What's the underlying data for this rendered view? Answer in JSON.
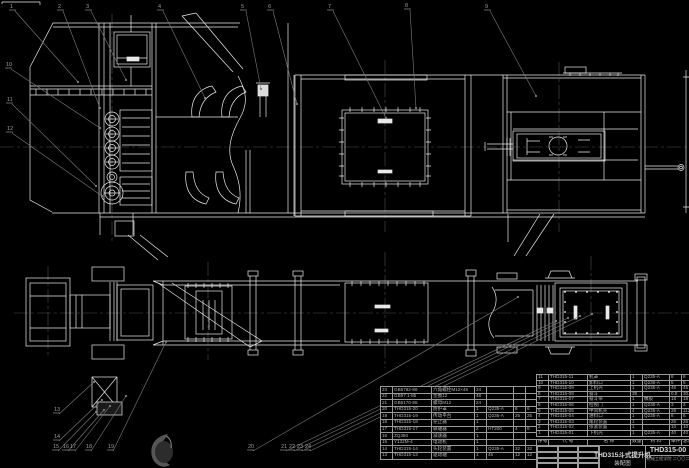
{
  "colors": {
    "background": "#000000",
    "line": "#e9e9e9",
    "leader": "#7d7d7d",
    "balloon_text": "#9c9c9c",
    "centerline": "#4f4f4f",
    "table_line": "#9a9a9a",
    "table_text": "#b5b5b5"
  },
  "title_block": {
    "title_line1": "THD315斗式提升机",
    "title_line2": "装配图",
    "drawing_number": "THD315-00",
    "org_line": "机械工程学院 二〇〇二"
  },
  "bom": {
    "header": [
      "序号",
      "代  号",
      "名  称",
      "数量",
      "材  料",
      "单件",
      "总计",
      "备注"
    ],
    "rows_right": [
      [
        "11",
        "THD315-11",
        "机罩",
        "1",
        "Q235-A",
        "8",
        "8",
        ""
      ],
      [
        "10",
        "THD315-10",
        "卸料口",
        "1",
        "Q235-A",
        "5",
        "5",
        ""
      ],
      [
        "9",
        "THD315-09",
        "上机壳",
        "1",
        "Q235-A",
        "45",
        "45",
        ""
      ],
      [
        "8",
        "THD315-08",
        "畚斗",
        "38",
        "",
        "0.8",
        "30.4",
        "外购"
      ],
      [
        "7",
        "THD315-07",
        "畚斗带",
        "1",
        "橡胶",
        "18",
        "18",
        "外购"
      ],
      [
        "6",
        "THD315-06",
        "检视门",
        "1",
        "Q235-A",
        "3",
        "3",
        ""
      ],
      [
        "5",
        "THD315-05",
        "中间机壳",
        "4",
        "Q235-A",
        "28",
        "112",
        ""
      ],
      [
        "4",
        "THD315-04",
        "进料口",
        "1",
        "Q235-A",
        "6",
        "6",
        ""
      ],
      [
        "3",
        "THD315-03",
        "尾轮装置",
        "1",
        "",
        "26",
        "26",
        ""
      ],
      [
        "2",
        "THD315-02",
        "张紧装置",
        "1",
        "",
        "10",
        "10",
        ""
      ],
      [
        "1",
        "THD315-01",
        "下机壳",
        "1",
        "Q235-A",
        "40",
        "40",
        ""
      ]
    ],
    "rows_left": [
      [
        "23",
        "GB5782-86",
        "六角螺栓M12×45",
        "24",
        "",
        "",
        "",
        "外购"
      ],
      [
        "22",
        "GB97.1-85",
        "垫圈12",
        "48",
        "",
        "",
        "",
        "外购"
      ],
      [
        "21",
        "GB6170-86",
        "螺母M12",
        "24",
        "",
        "",
        "",
        "外购"
      ],
      [
        "20",
        "THD315-20",
        "防护罩",
        "1",
        "Q235-A",
        "6",
        "6",
        ""
      ],
      [
        "19",
        "THD315-19",
        "传动平台",
        "1",
        "Q235-A",
        "25",
        "25",
        ""
      ],
      [
        "18",
        "THD315-18",
        "逆止器",
        "1",
        "",
        "",
        "",
        "外购"
      ],
      [
        "17",
        "THD315-17",
        "联轴器",
        "2",
        "HT200",
        "4",
        "8",
        ""
      ],
      [
        "16",
        "ZQ350",
        "减速器",
        "1",
        "",
        "",
        "",
        "外购"
      ],
      [
        "15",
        "Y132M-4",
        "电动机",
        "1",
        "",
        "",
        "",
        "外购"
      ],
      [
        "14",
        "THD315-14",
        "头轮装置",
        "1",
        "Q235-A",
        "32",
        "32",
        ""
      ],
      [
        "13",
        "THD315-13",
        "驱动轴",
        "1",
        "45",
        "12",
        "12",
        ""
      ]
    ]
  },
  "balloons": [
    {
      "n": "1",
      "x": 10,
      "y": 8,
      "tx": 78,
      "ty": 82
    },
    {
      "n": "2",
      "x": 58,
      "y": 8,
      "tx": 100,
      "ty": 108
    },
    {
      "n": "3",
      "x": 86,
      "y": 8,
      "tx": 126,
      "ty": 80
    },
    {
      "n": "4",
      "x": 158,
      "y": 8,
      "tx": 205,
      "ty": 98
    },
    {
      "n": "5",
      "x": 241,
      "y": 8,
      "tx": 261,
      "ty": 89
    },
    {
      "n": "6",
      "x": 268,
      "y": 8,
      "tx": 297,
      "ty": 104
    },
    {
      "n": "7",
      "x": 328,
      "y": 8,
      "tx": 386,
      "ty": 118
    },
    {
      "n": "8",
      "x": 405,
      "y": 7,
      "tx": 416,
      "ty": 108
    },
    {
      "n": "9",
      "x": 485,
      "y": 8,
      "tx": 536,
      "ty": 96
    },
    {
      "n": "10",
      "x": 6,
      "y": 66,
      "tx": 100,
      "ty": 128
    },
    {
      "n": "11",
      "x": 7,
      "y": 101,
      "tx": 96,
      "ty": 186
    },
    {
      "n": "12",
      "x": 7,
      "y": 130,
      "tx": 102,
      "ty": 196
    },
    {
      "n": "13",
      "x": 54,
      "y": 411,
      "tx": 94,
      "ty": 382
    },
    {
      "n": "14",
      "x": 54,
      "y": 438,
      "tx": 102,
      "ty": 400
    },
    {
      "n": "15",
      "x": 53,
      "y": 448,
      "tx": 96,
      "ty": 412
    },
    {
      "n": "16",
      "x": 63,
      "y": 448,
      "tx": 104,
      "ty": 410
    },
    {
      "n": "17",
      "x": 70,
      "y": 448,
      "tx": 110,
      "ty": 406
    },
    {
      "n": "18",
      "x": 86,
      "y": 448,
      "tx": 126,
      "ty": 396
    },
    {
      "n": "19",
      "x": 108,
      "y": 448,
      "tx": 166,
      "ty": 342
    },
    {
      "n": "20",
      "x": 248,
      "y": 448,
      "tx": 518,
      "ty": 297
    },
    {
      "n": "21",
      "x": 281,
      "y": 448,
      "tx": 556,
      "ty": 321
    },
    {
      "n": "22",
      "x": 289,
      "y": 448,
      "tx": 568,
      "ty": 318
    },
    {
      "n": "23",
      "x": 297,
      "y": 448,
      "tx": 580,
      "ty": 316
    },
    {
      "n": "24",
      "x": 305,
      "y": 448,
      "tx": 592,
      "ty": 314
    }
  ]
}
